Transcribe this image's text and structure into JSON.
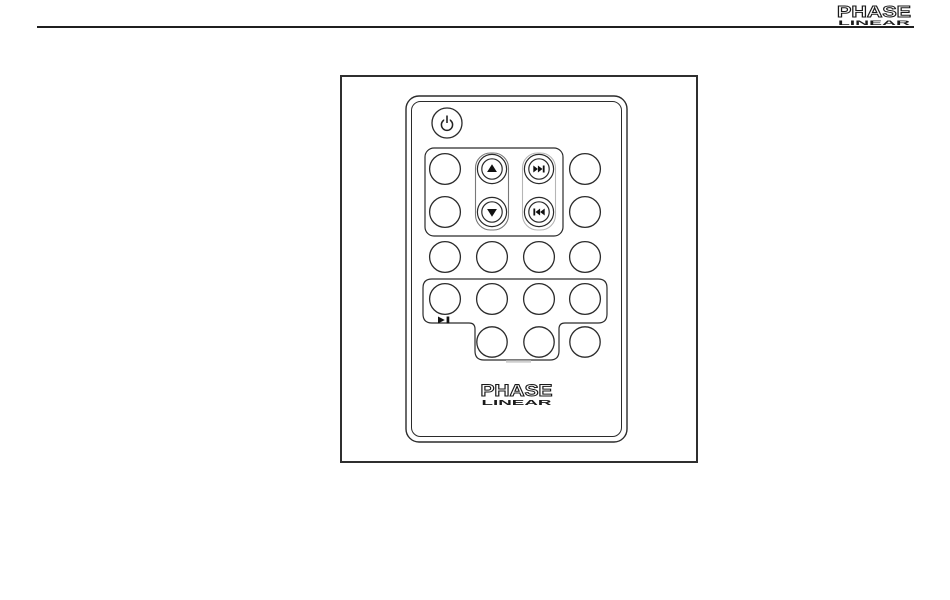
{
  "page": {
    "top_logo": {
      "word1": "PHASE",
      "word2": "LINEAR"
    }
  },
  "figure": {
    "remote_logo": {
      "word1": "PHASE",
      "word2": "LINEAR"
    },
    "icons": [
      "power-icon",
      "up-arrow-icon",
      "down-arrow-icon",
      "next-track-icon",
      "previous-track-icon",
      "play-pause-icon"
    ],
    "button_rows": {
      "row1": [
        "unlabeled",
        "up-arrow",
        "next-track",
        "unlabeled"
      ],
      "row2": [
        "unlabeled",
        "down-arrow",
        "previous-track",
        "unlabeled"
      ],
      "row3": [
        "unlabeled",
        "unlabeled",
        "unlabeled",
        "unlabeled"
      ],
      "row4": [
        "play-pause",
        "unlabeled",
        "unlabeled",
        "unlabeled"
      ],
      "row5": [
        "unlabeled",
        "unlabeled",
        "unlabeled"
      ]
    },
    "colors": {
      "line_dark": "#2b2b2b",
      "pill_mid_gray": "#787878",
      "pill_light_gray": "#b5b5b5",
      "notch_gray": "#cfcfcf",
      "logo_ink": "#1a1a1a"
    }
  }
}
